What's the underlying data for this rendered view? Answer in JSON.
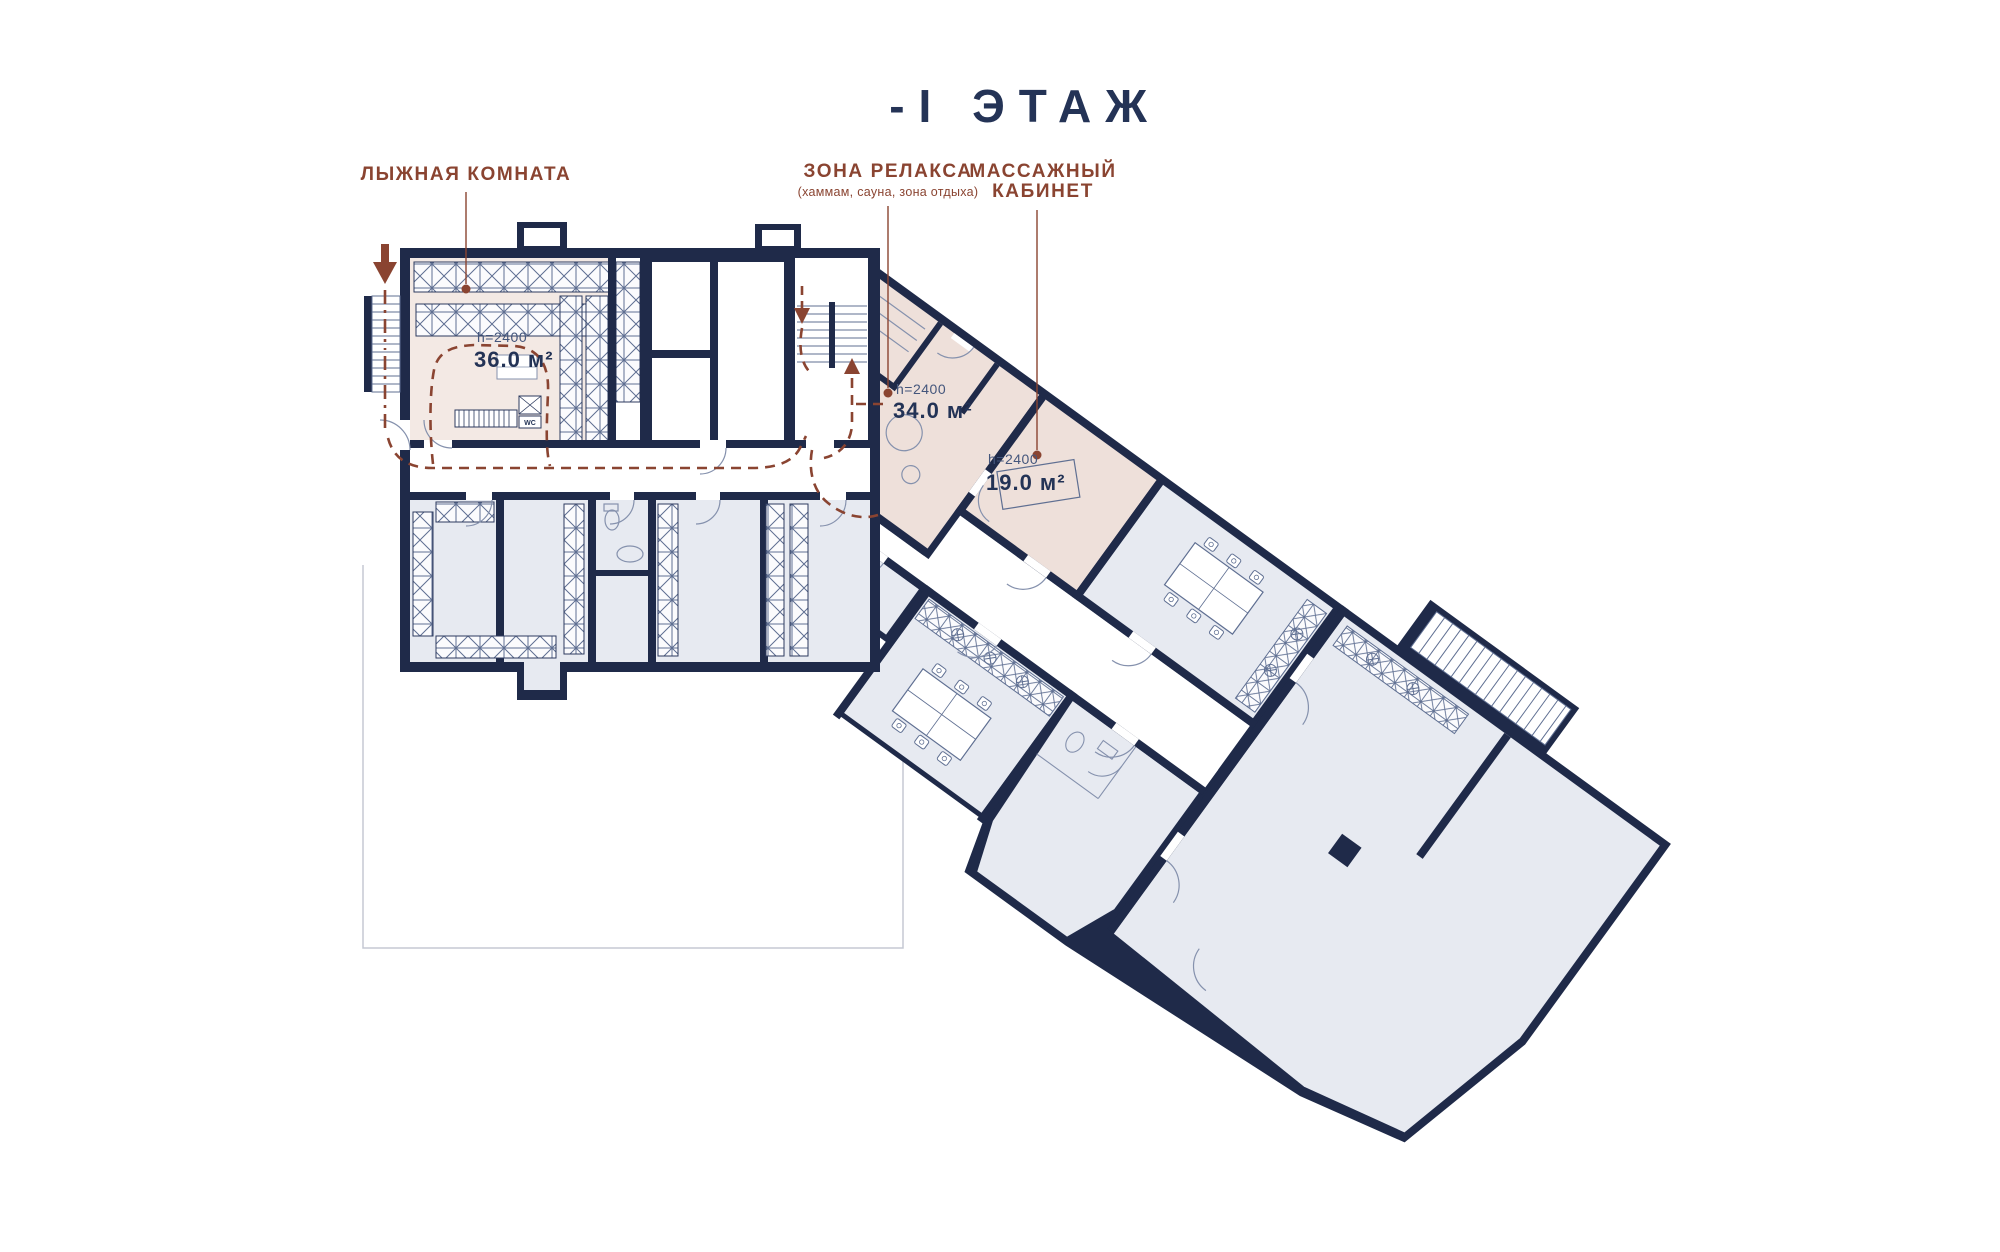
{
  "title": "-I ЭТАЖ",
  "legend": {
    "ski_room": {
      "label": "ЛЫЖНАЯ КОМНАТА"
    },
    "relax_zone": {
      "label": "ЗОНА РЕЛАКСА",
      "sublabel": "(хаммам, сауна, зона отдыха)"
    },
    "massage_room": {
      "label_line1": "МАССАЖНЫЙ",
      "label_line2": "КАБИНЕТ"
    }
  },
  "rooms": {
    "ski_room": {
      "ceiling": "h=2400",
      "area": "36.0 м²"
    },
    "relax_zone": {
      "ceiling": "h=2400",
      "area": "34.0 м²"
    },
    "massage_room": {
      "ceiling": "h=2400",
      "area": "19.0 м²"
    }
  },
  "plan": {
    "wc_label": "WC"
  },
  "icons": {
    "entry_arrow": "▼",
    "stairs_down_arrow": "▼",
    "stairs_up_arrow": "▲",
    "leader_dot": "●"
  },
  "colors": {
    "wall": "#1f2a49",
    "room_gray": "#e7eaf1",
    "room_white": "#ffffff",
    "highlight_ski": "#f3e9e4",
    "highlight_spa": "#eee0da",
    "accent_brown": "#8a4431",
    "thin_line": "#8591ad",
    "ground_line": "#c5c9d4"
  }
}
